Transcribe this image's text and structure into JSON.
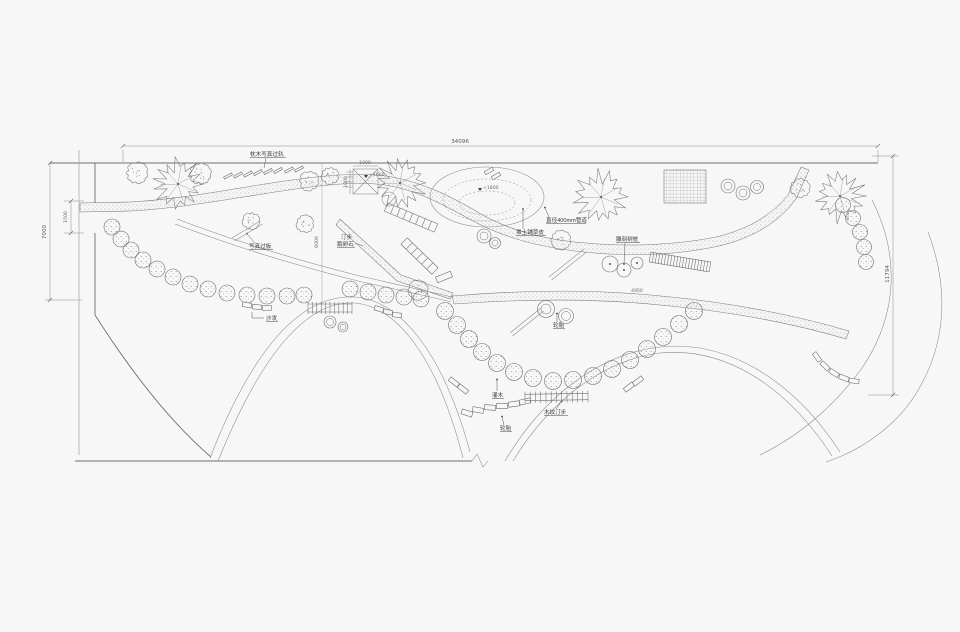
{
  "drawing": {
    "background": "#f7f7f8",
    "line_color": "#6f6f6f",
    "text_color": "#3c3c3c"
  },
  "dimensions": {
    "site_width": "34096",
    "site_left_height": "7000",
    "left_opening": "1500",
    "center_depth": "8000",
    "site_right_height": "11794",
    "platform_width": "1000",
    "platform_depth": "1000",
    "path_segment": "4950"
  },
  "spot_levels": {
    "platform": "+1660",
    "mound": "+1800"
  },
  "labels": {
    "top_walkway": "枕木写真过轨",
    "photo_board": "写真过板",
    "stepping_stones_1": "汀步",
    "stepping_stones_2": "鹅卵石",
    "sand_seat": "沙发",
    "carved_stumps": "雕刻树桩",
    "earth_mound_turf": "堆土铺草皮",
    "pipe_400": "直径400mm管道",
    "shrubs": "灌木",
    "tires_upper": "轮胎",
    "tires_lower": "轮胎",
    "wood_grain_steps": "木纹汀步"
  }
}
